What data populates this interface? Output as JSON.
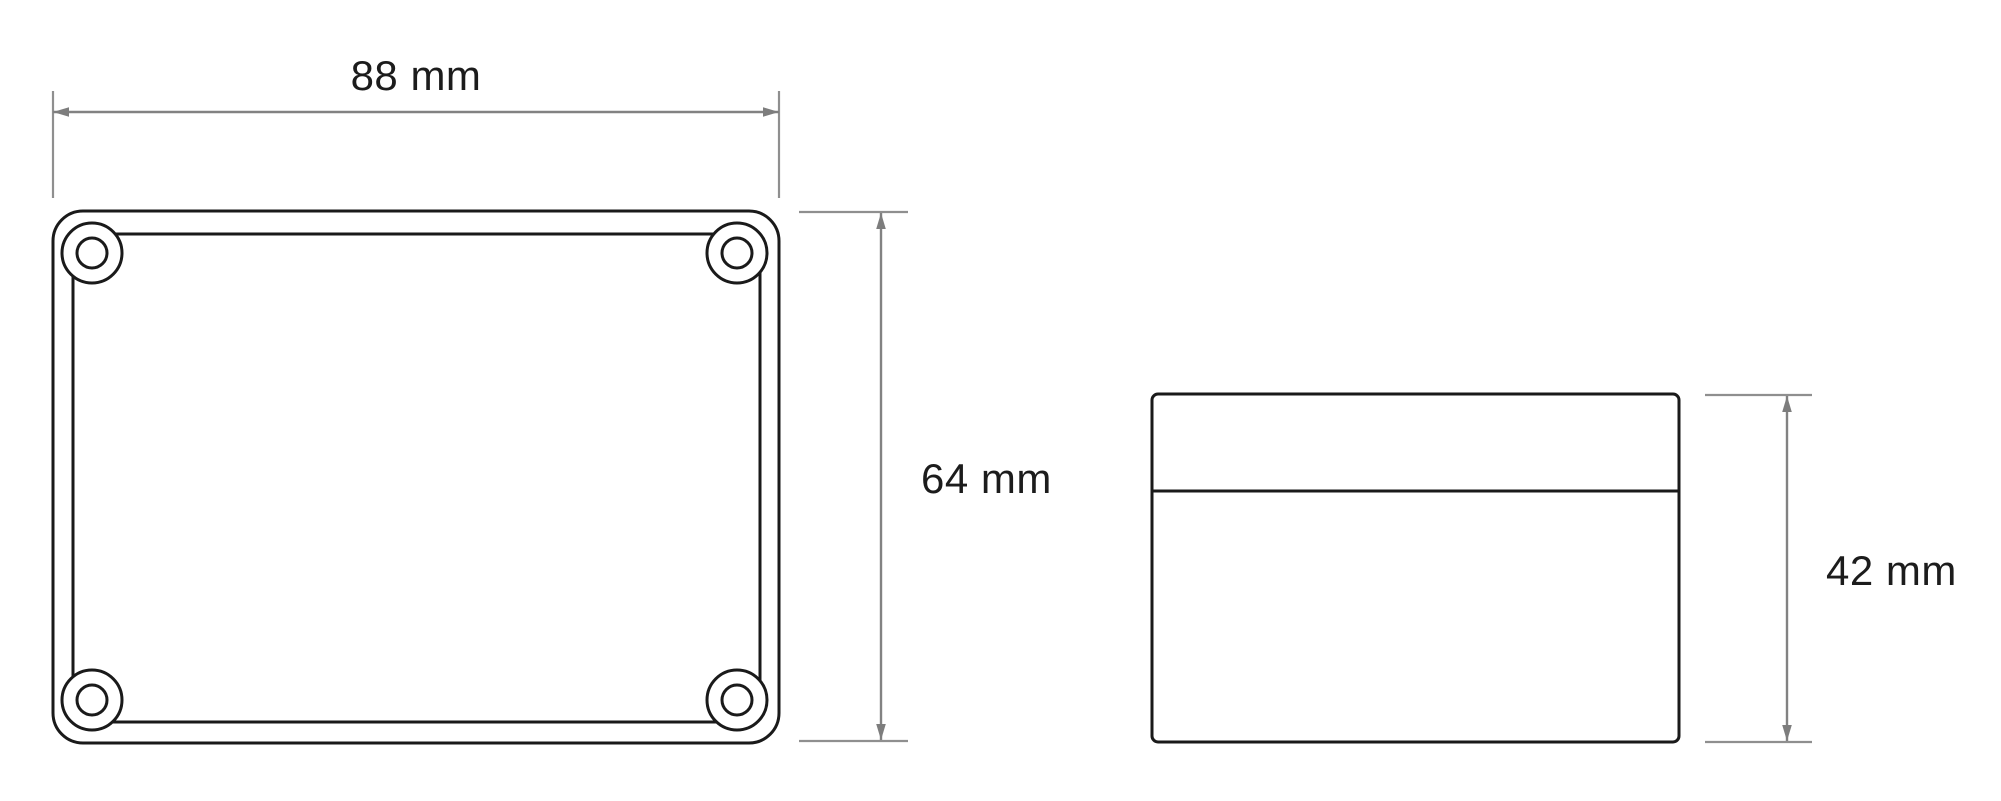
{
  "drawing": {
    "type": "technical-dimension-drawing",
    "subject": "enclosure-box",
    "labels": {
      "top_width": "88 mm",
      "top_height": "64 mm",
      "side_height": "42 mm"
    },
    "values": {
      "top_width_mm": 88,
      "top_height_mm": 64,
      "side_height_mm": 42,
      "unit": "mm"
    },
    "colors": {
      "outline": "#1a1a1a",
      "dimension_line": "#828282",
      "extension_line": "#8f8f8f",
      "arrowhead": "#7d7d7d",
      "text": "#1c1c1c",
      "background": "#ffffff"
    }
  }
}
